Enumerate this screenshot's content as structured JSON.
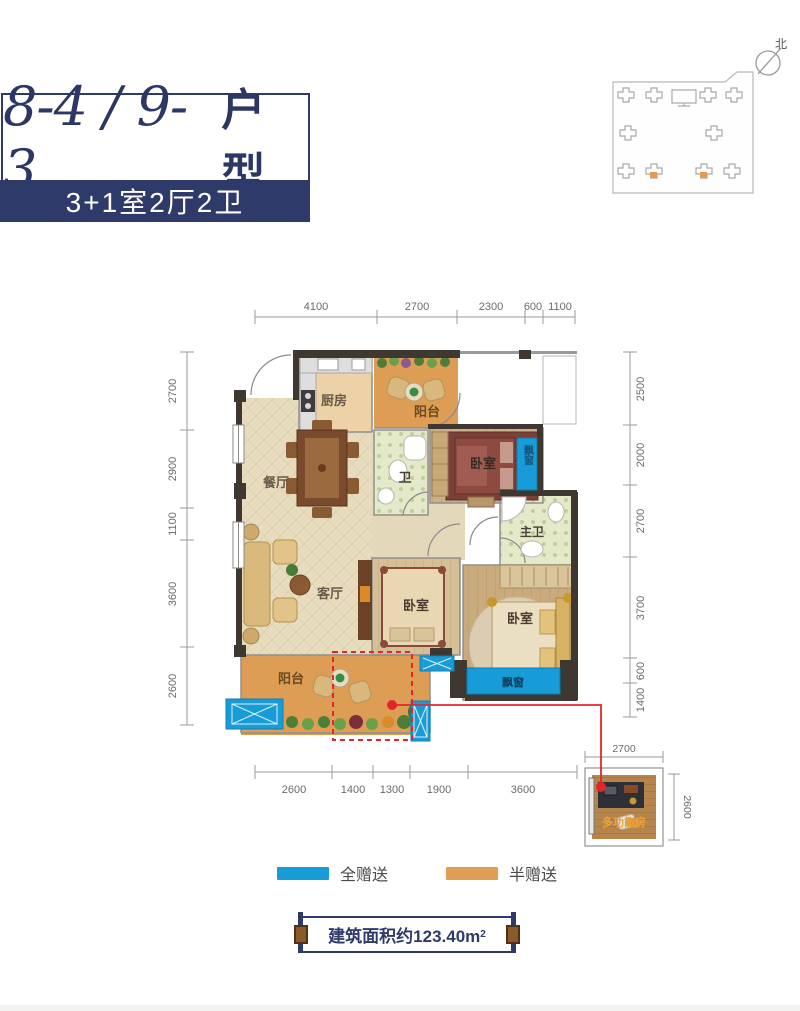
{
  "title": {
    "numbers": "8-4 / 9-3",
    "suffix": "户型",
    "subtitle": "3+1室2厅2卫"
  },
  "key_plan": {
    "north_label": "北"
  },
  "dims": {
    "top": [
      "4100",
      "2700",
      "2300",
      "600",
      "1100"
    ],
    "left": [
      "2700",
      "2900",
      "1100",
      "3600",
      "2600"
    ],
    "right": [
      "2500",
      "2000",
      "2700",
      "3700",
      "600",
      "1400"
    ],
    "bottom": [
      "2600",
      "1400",
      "1300",
      "1900",
      "3600"
    ],
    "annex_top": "2700",
    "annex_right": "2600"
  },
  "rooms": {
    "kitchen": "厨房",
    "balcony_top": "阳台",
    "dining": "餐厅",
    "bath": "卫",
    "bedroom_top": "卧室",
    "bay_right": "飘窗",
    "master_bath": "主卫",
    "living": "客厅",
    "bedroom_mid": "卧室",
    "bedroom_master": "卧室",
    "bay_bottom": "飘窗",
    "balcony_bottom": "阳台",
    "multi_room": "多功能房"
  },
  "legend": {
    "full": "全赠送",
    "half": "半赠送"
  },
  "area": {
    "label": "建筑面积约123.40m",
    "sup": "2"
  },
  "colors": {
    "full_gift": "#189cd8",
    "half_gift": "#de9e54",
    "navy": "#2e3a6a",
    "red": "#e5252a"
  }
}
